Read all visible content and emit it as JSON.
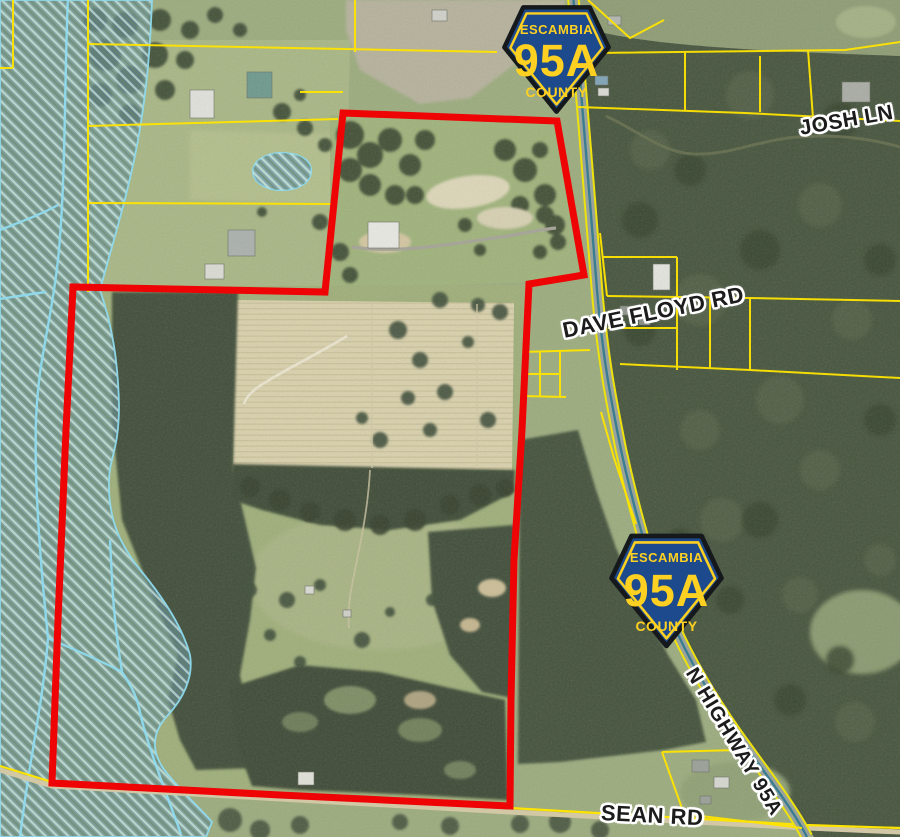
{
  "road_labels": {
    "josh_ln": "JOSH LN",
    "dave_floyd_rd": "DAVE FLOYD RD",
    "sean_rd": "SEAN RD",
    "n_highway_95a": "N HIGHWAY 95A"
  },
  "route_shields": [
    {
      "county": "ESCAMBIA",
      "route": "95A",
      "label": "COUNTY"
    },
    {
      "county": "ESCAMBIA",
      "route": "95A",
      "label": "COUNTY"
    }
  ],
  "map_colors": {
    "subject_parcel_outline": "#ee0404",
    "parcel_lines": "#ffe400",
    "wetland_outline": "#8fdbef",
    "shield_blue": "#1d4a8c",
    "shield_yellow": "#fdd021",
    "highway_edge": "#eee20c"
  }
}
